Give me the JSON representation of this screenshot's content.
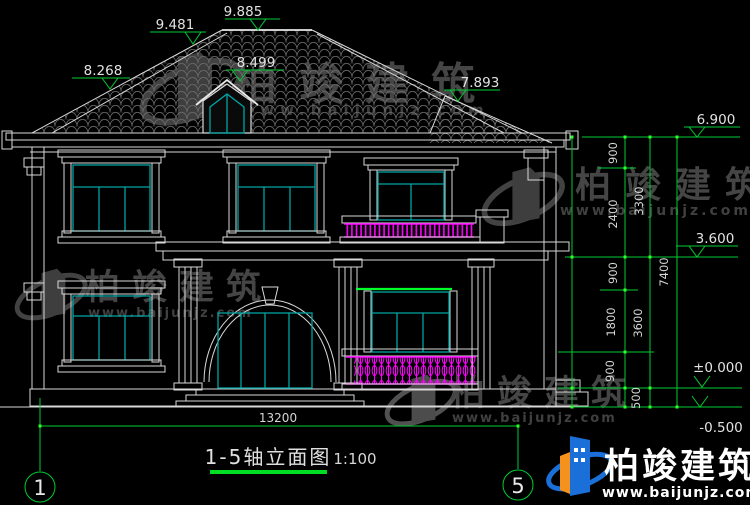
{
  "drawing": {
    "title": "1-5轴立面图",
    "scale": "1:100",
    "axis_bubbles": {
      "left": "1",
      "right": "5"
    },
    "elevations": {
      "ridge": "9.885",
      "upper_hip": "9.481",
      "dormer": "8.499",
      "left_hip": "8.268",
      "right_roof": "7.893",
      "eave": "6.900",
      "second_floor": "3.600",
      "ground": "±0.000",
      "grade": "-0.500"
    },
    "dimensions": {
      "total_width": "13200",
      "right_chain_segments": [
        "900",
        "2400",
        "900",
        "1800",
        "900"
      ],
      "right_chain_floors": [
        "3300",
        "3600",
        "500"
      ],
      "right_overall": "7400"
    },
    "colors": {
      "background": "#000000",
      "line_white": "#d8d8d8",
      "window_teal": "#00a3a3",
      "dimension_green": "#00cc33",
      "lintel_green": "#00ff2a",
      "railing_magenta": "#ff00ff",
      "watermark_gray": "#4d4d4d",
      "logo_blue": "#1b6fd8",
      "logo_orange": "#f5921e"
    }
  },
  "watermark": {
    "brand": "柏竣建筑",
    "site": "www.baijunjz.com"
  }
}
